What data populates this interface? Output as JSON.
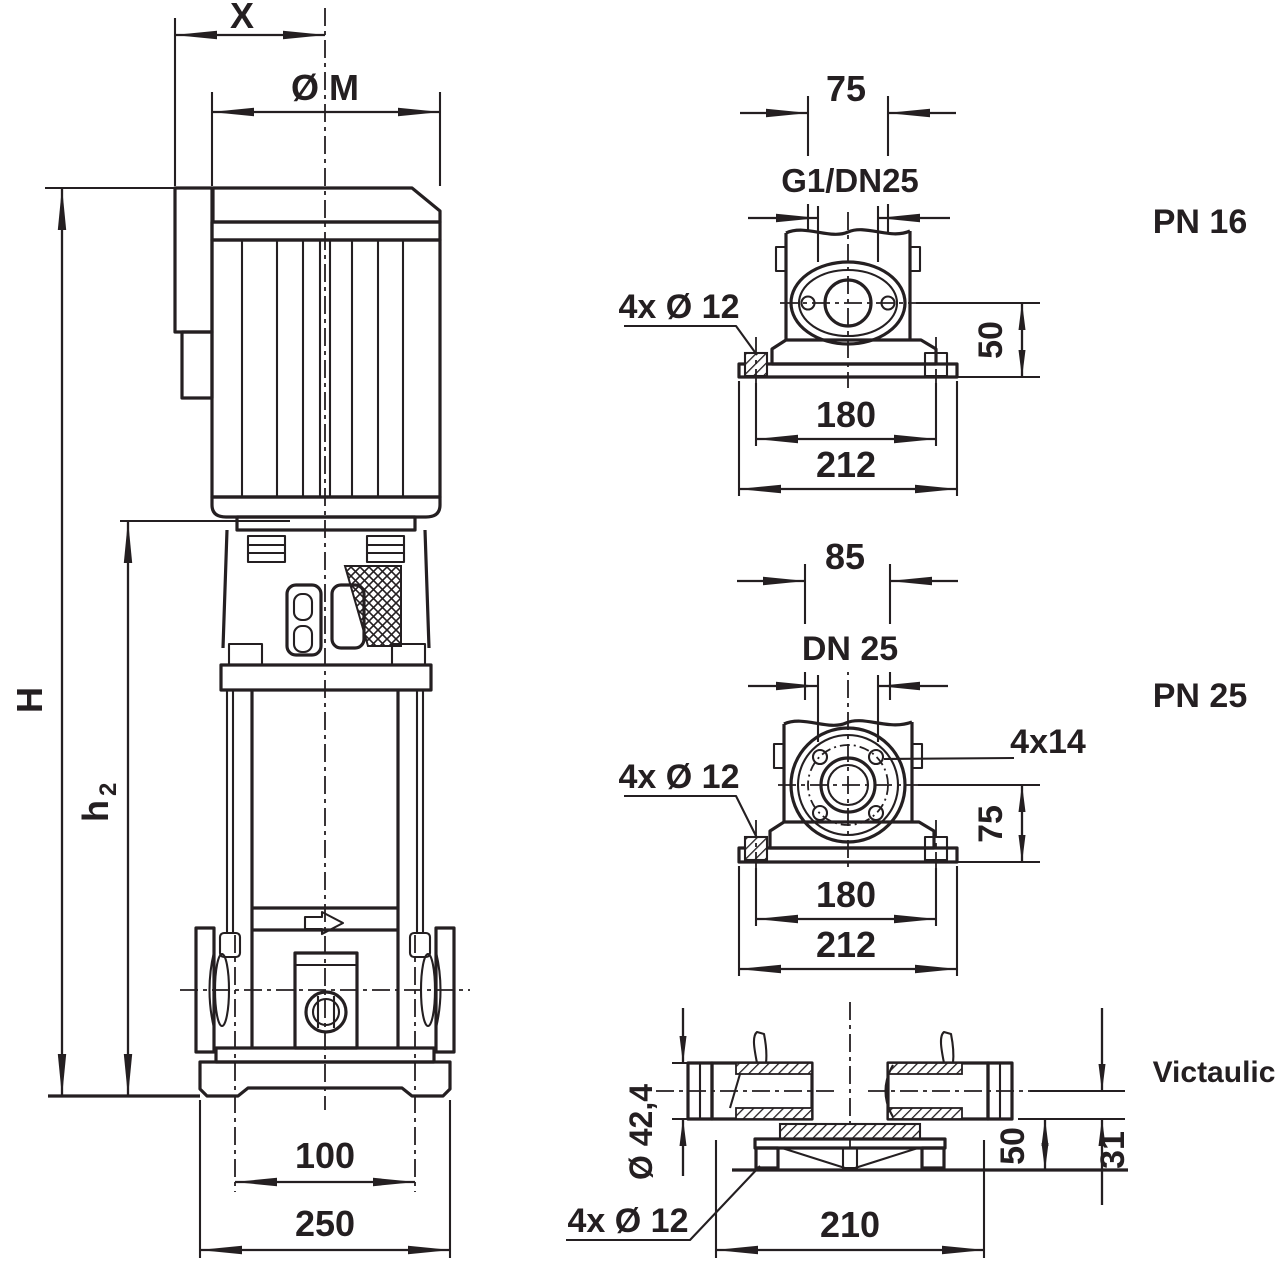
{
  "drawing_title": "Vertical multistage pump dimensional drawing",
  "colors": {
    "line": "#241f21",
    "background": "#ffffff"
  },
  "main_view": {
    "dim_x_label": "X",
    "dim_diameter_label": "Ø M",
    "dim_height_label": "H",
    "dim_h2_base": "h",
    "dim_h2_sub": "2",
    "dim_port_spacing": "100",
    "dim_base_width": "250"
  },
  "pn16_view": {
    "title": "PN 16",
    "dim_port_offset": "75",
    "connection_label": "G1/DN25",
    "bolt_label": "4x Ø 12",
    "dim_port_height": "50",
    "dim_bolt_spacing": "180",
    "dim_base_width": "212"
  },
  "pn25_view": {
    "title": "PN 25",
    "dim_port_offset": "85",
    "connection_label": "DN 25",
    "flange_bolt_label": "4x14",
    "bolt_label": "4x Ø 12",
    "dim_port_height": "75",
    "dim_bolt_spacing": "180",
    "dim_base_width": "212"
  },
  "victaulic_view": {
    "title": "Victaulic",
    "dim_pipe_od": "Ø 42,4",
    "bolt_label": "4x Ø 12",
    "dim_base_width": "210",
    "dim_stub_height": "31",
    "dim_port_height": "50"
  }
}
